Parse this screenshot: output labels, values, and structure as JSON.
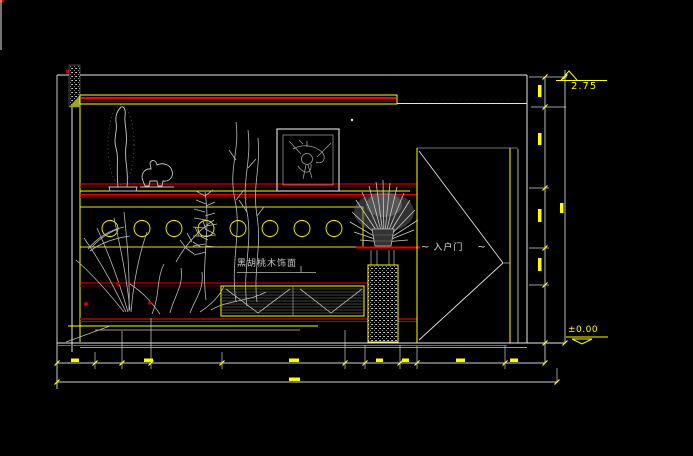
{
  "app": {
    "type": "CAD interior elevation drawing (entry hallway)",
    "background_color": "#000000"
  },
  "labels": {
    "elevation_top": "2.75",
    "elevation_floor": "±0.00",
    "material": "黑胡桃木饰面",
    "door": "入户门",
    "door_tilde_left": "~",
    "door_tilde_right": "~"
  },
  "colors": {
    "line_white": "#e8e8e8",
    "line_gray": "#b9b9b9",
    "accent_yellow": "#ffff00",
    "accent_red": "#ff0000",
    "accent_dark_red": "#7a0000",
    "accent_magenta": "#ff00ff",
    "accent_blue_dashed": "#00008b",
    "hatch_green": "#9aa02c"
  },
  "drawing_elements": [
    "ceiling line with hatched wall column at left",
    "soffit band with double red trim lines",
    "standing abstract sculpture and animal figurine on shelf",
    "framed abstract artwork",
    "band of 8 circular ornaments",
    "ornamental plants and grasses",
    "black walnut veneer panel (labeled)",
    "louvered bench with X cross pattern",
    "potted plant on mosaic pedestal",
    "entry door panel with swing diagonals (labeled)",
    "floor line (white / magenta / yellow)",
    "bottom and right dimension chains"
  ],
  "dimensions_note": "tiny yellow dimension numerals are present along bottom and right dimension lines but are illegible at source resolution; rendered as smudge marks",
  "elevation_markers": [
    {
      "value": "2.75",
      "position": "top-right"
    },
    {
      "value": "±0.00",
      "position": "floor-right"
    }
  ]
}
